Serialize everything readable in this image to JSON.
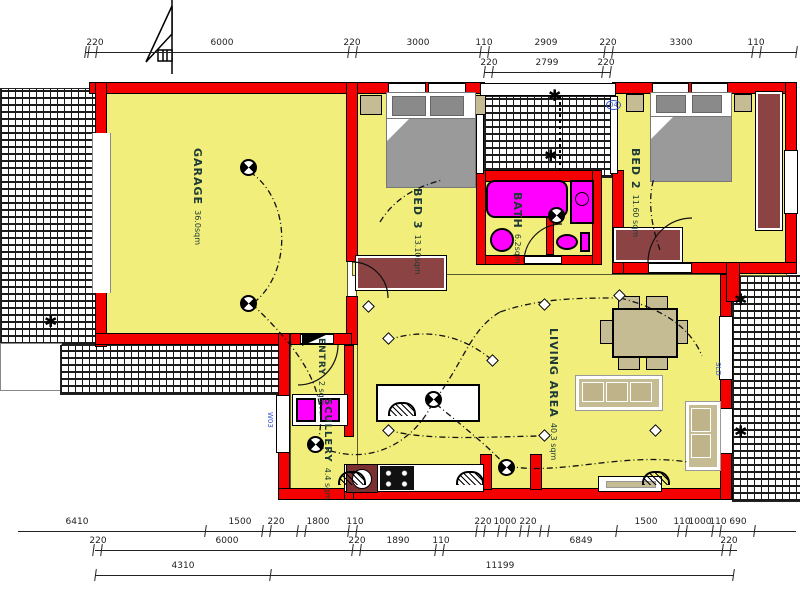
{
  "plan": {
    "rooms": {
      "garage": {
        "name": "GARAGE",
        "area": "36.0sqm"
      },
      "bed3": {
        "name": "BED 3",
        "area": "13.10sqm"
      },
      "bath": {
        "name": "BATH",
        "area": "6.2sqm"
      },
      "bed2": {
        "name": "BED 2",
        "area": "11.60 sqm"
      },
      "entry": {
        "name": "ENTRY",
        "area": "2 sqm"
      },
      "scullery": {
        "name": "SCULLERY",
        "area": "4.4 sqm"
      },
      "living": {
        "name": "LIVING AREA",
        "area": "40.3 sqm"
      }
    },
    "window_labels": {
      "w03": "W03",
      "w04": "04",
      "sld": "SLD"
    }
  },
  "colors": {
    "floor": "#F2EE7B",
    "wall_red": "#F40000",
    "fixture_magenta": "#FF00FF",
    "robe_maroon": "#8C4343",
    "furniture_tan": "#C6BC94",
    "bed_gray": "#9A9A9A",
    "window_label_blue": "#3355cc"
  },
  "dimensions": {
    "top": [
      {
        "y": 38,
        "line_y": 52,
        "x1": 85,
        "x2": 796,
        "ticks": [
          85,
          88,
          96,
          348,
          356,
          480,
          488,
          604,
          612,
          752,
          760,
          796
        ],
        "labels": [
          {
            "v": "220",
            "x": 95
          },
          {
            "v": "6000",
            "x": 222
          },
          {
            "v": "220",
            "x": 352
          },
          {
            "v": "3000",
            "x": 418
          },
          {
            "v": "110",
            "x": 484
          },
          {
            "v": "2909",
            "x": 546
          },
          {
            "v": "220",
            "x": 608
          },
          {
            "v": "3300",
            "x": 681
          },
          {
            "v": "110",
            "x": 756
          }
        ]
      },
      {
        "y": 58,
        "line_y": 72,
        "x1": 484,
        "x2": 610,
        "ticks": [
          484,
          492,
          602,
          610
        ],
        "labels": [
          {
            "v": "220",
            "x": 489
          },
          {
            "v": "2799",
            "x": 547
          },
          {
            "v": "220",
            "x": 606
          }
        ]
      }
    ],
    "bottom": [
      {
        "y": 517,
        "line_y": 531,
        "x1": 18,
        "x2": 796,
        "ticks": [
          205,
          262,
          270,
          297,
          305,
          348,
          356,
          476,
          484,
          498,
          506,
          520,
          528,
          540,
          548,
          616,
          678,
          686,
          712,
          720,
          754
        ],
        "labels": [
          {
            "v": "6410",
            "x": 77
          },
          {
            "v": "1500",
            "x": 240
          },
          {
            "v": "220",
            "x": 276
          },
          {
            "v": "1800",
            "x": 318
          },
          {
            "v": "110",
            "x": 355
          },
          {
            "v": "220",
            "x": 483
          },
          {
            "v": "1000",
            "x": 505
          },
          {
            "v": "220",
            "x": 528
          },
          {
            "v": "1500",
            "x": 646
          },
          {
            "v": "110",
            "x": 682
          },
          {
            "v": "1000",
            "x": 700
          },
          {
            "v": "110",
            "x": 718
          },
          {
            "v": "690",
            "x": 738
          }
        ]
      },
      {
        "y": 536,
        "line_y": 550,
        "x1": 95,
        "x2": 737,
        "ticks": [
          93,
          101,
          352,
          360,
          435,
          443,
          722,
          730
        ],
        "labels": [
          {
            "v": "220",
            "x": 98
          },
          {
            "v": "6000",
            "x": 227
          },
          {
            "v": "220",
            "x": 357
          },
          {
            "v": "1890",
            "x": 398
          },
          {
            "v": "110",
            "x": 441
          },
          {
            "v": "6849",
            "x": 581
          },
          {
            "v": "220",
            "x": 729
          }
        ]
      },
      {
        "y": 561,
        "line_y": 575,
        "x1": 95,
        "x2": 733,
        "ticks": [
          95,
          270,
          733
        ],
        "labels": [
          {
            "v": "4310",
            "x": 183
          },
          {
            "v": "11199",
            "x": 500
          }
        ]
      }
    ]
  },
  "symbols": {
    "lights": [
      [
        247,
        166
      ],
      [
        247,
        302
      ],
      [
        432,
        398
      ],
      [
        505,
        466
      ],
      [
        314,
        443
      ],
      [
        555,
        214
      ]
    ],
    "switches": [
      [
        388,
        338
      ],
      [
        388,
        430
      ],
      [
        544,
        304
      ],
      [
        544,
        435
      ],
      [
        492,
        360
      ],
      [
        619,
        295
      ],
      [
        655,
        430
      ],
      [
        368,
        306
      ]
    ],
    "shrubs": [
      [
        556,
        96
      ],
      [
        552,
        156
      ],
      [
        742,
        300
      ],
      [
        742,
        432
      ],
      [
        52,
        322
      ]
    ],
    "vents": [
      [
        350,
        477
      ],
      [
        468,
        477
      ],
      [
        654,
        477
      ],
      [
        400,
        408
      ]
    ]
  }
}
